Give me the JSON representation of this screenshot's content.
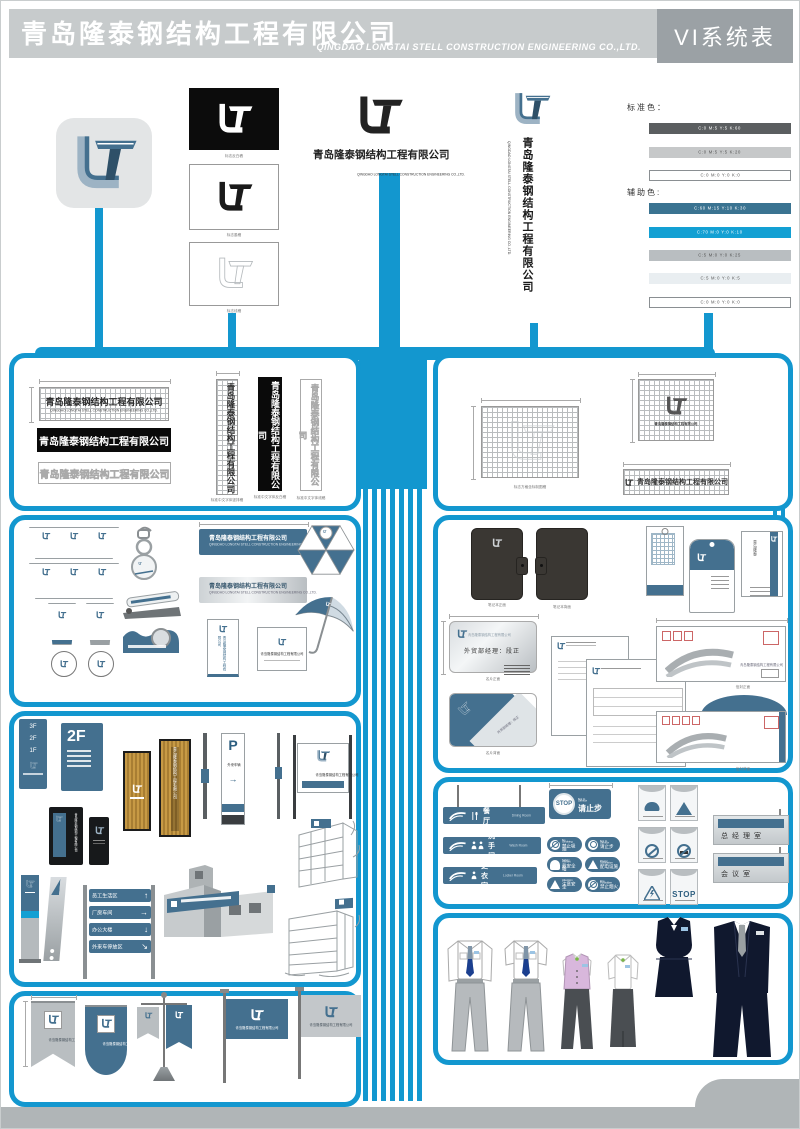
{
  "page": {
    "bg": "#ffffff",
    "accent": "#1397cf",
    "steel": "#44708f",
    "footer_gray": "#b0b5b7"
  },
  "header": {
    "title": "青岛隆泰钢结构工程有限公司",
    "subtitle": "QINGDAO LONGTAI STELL CONSTRUCTION ENGINEERING CO.,LTD.",
    "badge": "VI系统表",
    "band_color": "#c7cbcc",
    "badge_color": "#9ba1a5"
  },
  "logo": {
    "name": "青岛隆泰钢结构工程有限公司",
    "en": "QINGDAO LONGTAI STELL CONSTRUCTION ENGINEERING CO.,LTD.",
    "captions": [
      "标志反白稿",
      "标志墨稿",
      "标志线稿"
    ]
  },
  "colors": {
    "standard_label": "标准色：",
    "auxiliary_label": "辅助色:",
    "standard": [
      {
        "code": "C:0 M:5 Y:5 K:60",
        "hex": "#5b5e60",
        "fg": "#ffffff"
      },
      {
        "code": "C:0 M:5 Y:5 K:20",
        "hex": "#c6c8c9",
        "fg": "#555555"
      },
      {
        "code": "C:0 M:0 Y:0 K:0",
        "hex": "#ffffff",
        "fg": "#555555"
      }
    ],
    "auxiliary": [
      {
        "code": "C:60 M:15 Y:10 K:30",
        "hex": "#3a7391",
        "fg": "#ffffff"
      },
      {
        "code": "C:70 M:0 Y:0 K:10",
        "hex": "#13a0d3",
        "fg": "#ffffff"
      },
      {
        "code": "C:5 M:0 Y:0 K:25",
        "hex": "#b9bec1",
        "fg": "#555555"
      },
      {
        "code": "C:5 M:0 Y:0 K:5",
        "hex": "#e9eef1",
        "fg": "#555555"
      },
      {
        "code": "C:0 M:0 Y:0 K:0",
        "hex": "#ffffff",
        "fg": "#555555"
      }
    ]
  },
  "logotype": {
    "name": "青岛隆泰钢结构工程有限公司",
    "en": "QINGDAO LONGTAI STELL CONSTRUCTION ENGINEERING CO.,LTD.",
    "captions": [
      "标准中文字体竖排稿",
      "标准中文字体反白稿",
      "标准中文字体线稿"
    ],
    "grid_caption": "标志方格坐标制图稿"
  },
  "stationery": {
    "notebook_front": "笔记本正面",
    "notebook_back": "笔记本背面",
    "card_name": "外贸部经理：段正",
    "card_front": "名片正面",
    "card_back": "名片背面",
    "envelope_front": "信封正面",
    "envelope_back": "信封背面"
  },
  "signage": {
    "floors": [
      "3F",
      "2F",
      "1F"
    ],
    "floor_big": "2F",
    "parking": "P",
    "parking_sub": "外来车辆",
    "parking_arrow": "→",
    "directions": [
      {
        "label": "员工生活区",
        "arrow": "↑"
      },
      {
        "label": "厂房车间",
        "arrow": "→"
      },
      {
        "label": "办公大楼",
        "arrow": "↓"
      },
      {
        "label": "外来车停放区",
        "arrow": "↘"
      }
    ]
  },
  "interior": {
    "hanging": [
      "餐厅",
      "洗手间",
      "更衣室"
    ],
    "stop": {
      "word": "STOP",
      "en": "Not In Service",
      "cn": "请止步"
    },
    "ovals": [
      {
        "en": "No Smoking",
        "cn": "禁止吸烟"
      },
      {
        "en": "Not In Service",
        "cn": "请止步"
      },
      {
        "en": "Safety Helmet",
        "cn": "戴安全帽"
      },
      {
        "en": "Power Substation",
        "cn": "配电设施"
      },
      {
        "en": "Attention",
        "cn": "注意安全"
      },
      {
        "en": "Fire Forbidden",
        "cn": "禁止烟火"
      }
    ],
    "square_stop": "STOP",
    "plates": [
      "总经理室",
      "会议室"
    ]
  }
}
